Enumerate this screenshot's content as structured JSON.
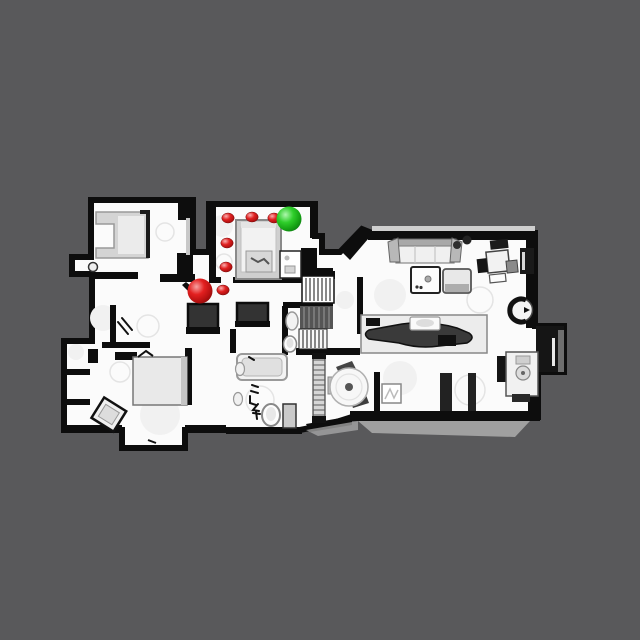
{
  "scene": {
    "background_color": "#59595b",
    "description": "Top-down scanned floor plan of a house shown as a navigation map",
    "floor_color": "#fbfbfb",
    "wall_color": "#0d0d0d"
  },
  "markers": {
    "goal": {
      "id": "goal",
      "color": "#2fce2b",
      "x": 289,
      "y": 219,
      "r": 12.5
    },
    "agent": {
      "id": "agent",
      "color": "#e32020",
      "x": 200,
      "y": 291,
      "r": 12.5
    },
    "path_color": "#e02020",
    "path_dot_rx": 6.2,
    "path_dot_ry": 5,
    "path_points": [
      {
        "x": 228,
        "y": 218
      },
      {
        "x": 252,
        "y": 217
      },
      {
        "x": 274,
        "y": 218
      },
      {
        "x": 227,
        "y": 243
      },
      {
        "x": 226,
        "y": 267
      },
      {
        "x": 223,
        "y": 290
      }
    ]
  }
}
